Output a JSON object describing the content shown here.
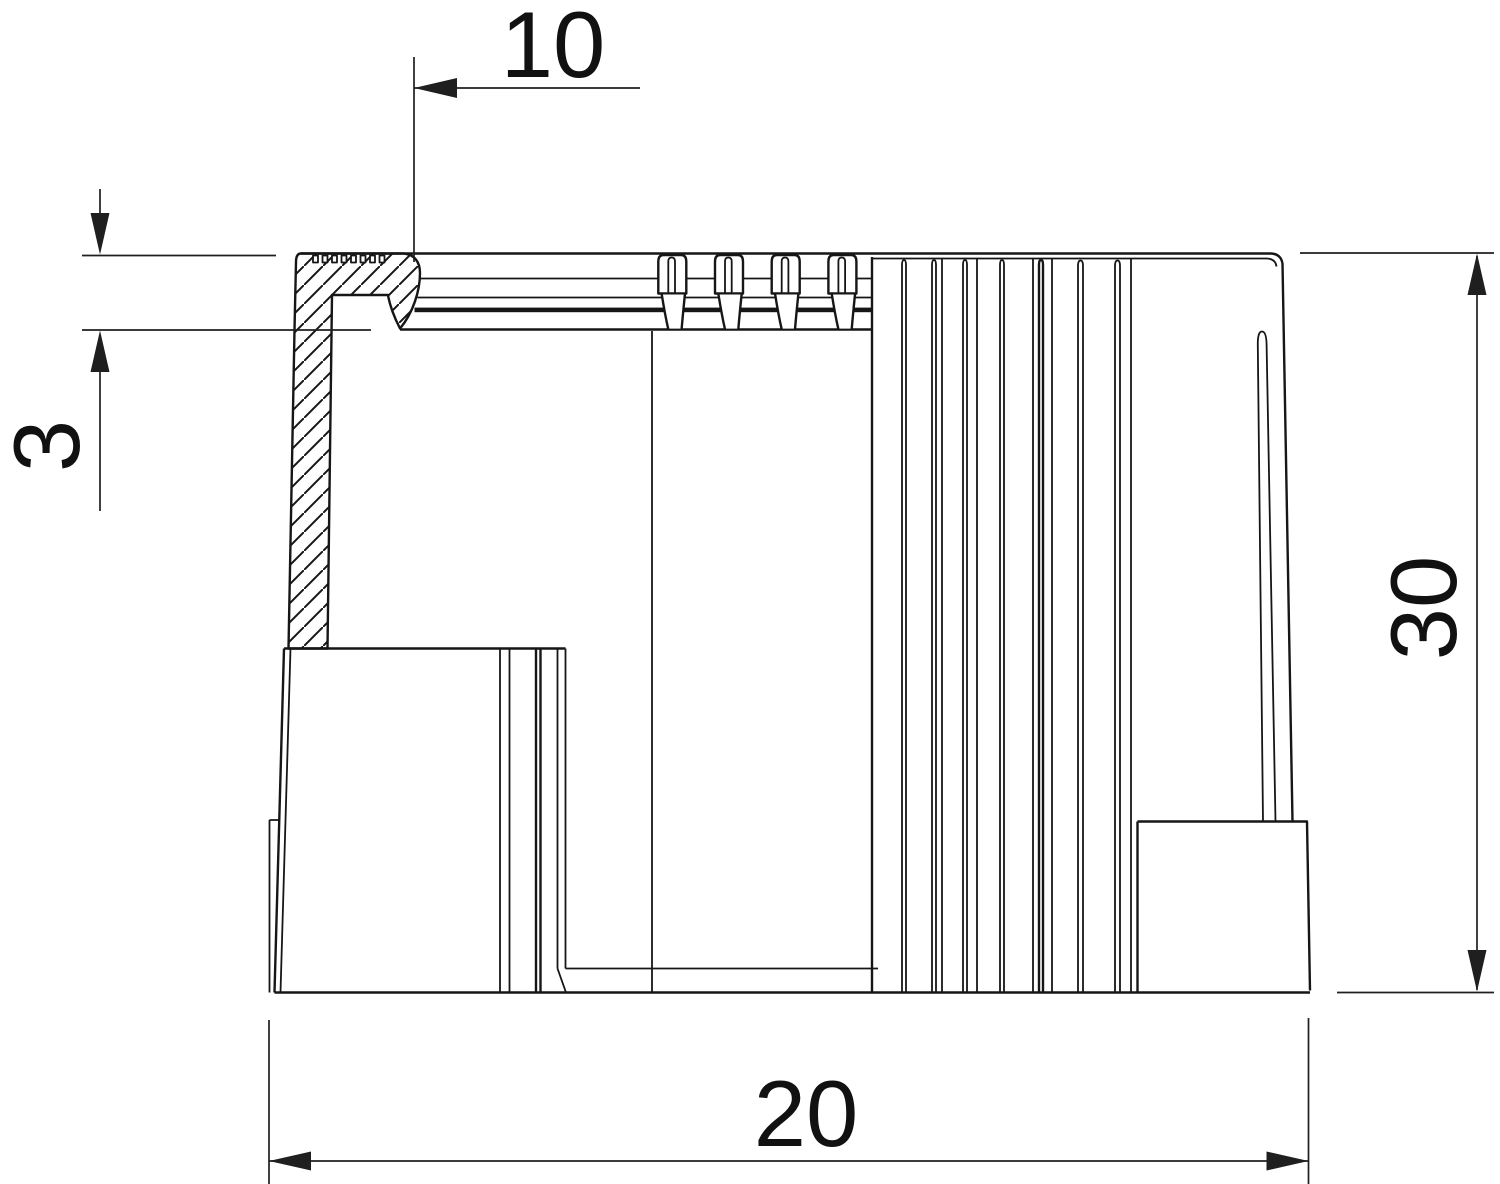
{
  "drawing": {
    "type": "technical-drawing",
    "view": "sectioned side view of knurled cap",
    "background": "#ffffff",
    "line_color": "#161616",
    "dimension_line_color": "#1f1f1f",
    "text_color": "#111111",
    "dimensions": {
      "top_offset": {
        "label": "10",
        "orientation": "horizontal"
      },
      "rim_depth": {
        "label": "3",
        "orientation": "vertical"
      },
      "overall_height": {
        "label": "30",
        "orientation": "vertical"
      },
      "overall_width": {
        "label": "20",
        "orientation": "horizontal"
      }
    }
  }
}
